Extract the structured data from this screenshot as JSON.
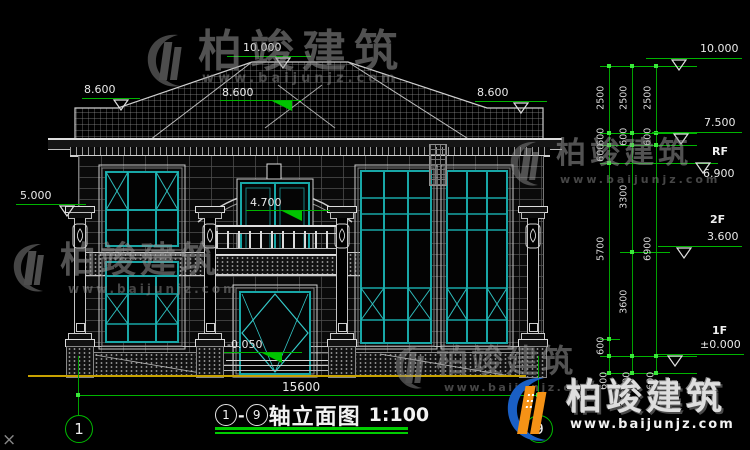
{
  "drawing": {
    "title_name": "轴立面图",
    "scale": "1:100",
    "axis_from": "1",
    "axis_to": "9",
    "dash": "-",
    "corner_mark": "×"
  },
  "axes": {
    "left_bubble": "1",
    "right_bubble": "9"
  },
  "dims": {
    "overall_width": "15600",
    "chain_a": [
      "2500",
      "600",
      "600",
      "5700",
      "600"
    ],
    "chain_b": [
      "2500",
      "600",
      "3300",
      "3600"
    ],
    "chain_c": [
      "2500",
      "600",
      "6900"
    ],
    "below_ground": [
      "600",
      "600",
      "600"
    ]
  },
  "elevations": {
    "ridge_center": "10.000",
    "roof_left": "8.600",
    "roof_mid": "8.600",
    "roof_right": "8.600",
    "wall_left": "5.000",
    "balcony": "4.700",
    "porch": "-0.050",
    "right_top": "10.000",
    "right_75": "7.500",
    "right_69": "6.900",
    "right_36": "3.600",
    "right_00": "±0.000",
    "label_rf": "RF",
    "label_2f": "2F",
    "label_1f": "1F"
  },
  "watermark": {
    "brand": "柏竣建筑",
    "url": "www.baijunjz.com"
  },
  "logo": {
    "brand": "柏竣建筑",
    "url": "www.baijunjz.com"
  },
  "colors": {
    "dim_green": "#00b400",
    "frame_teal": "#18a7a7",
    "ground_yellow": "#c8a200",
    "logo_blue": "#1a5fc4",
    "logo_orange": "#f59216"
  }
}
